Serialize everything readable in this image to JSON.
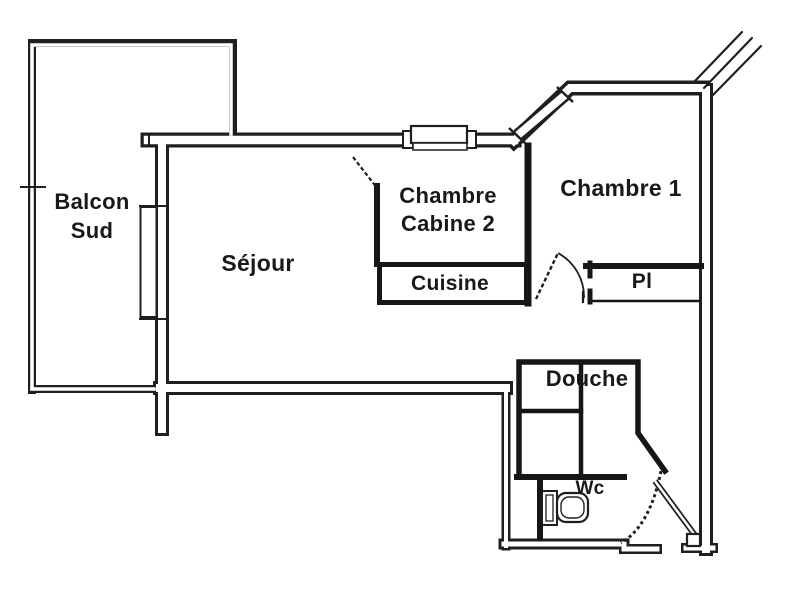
{
  "document": {
    "type": "apartment-floor-plan",
    "language": "fr"
  },
  "palette": {
    "wall": "#1f1f1f",
    "background": "#ffffff",
    "text": "#191919"
  },
  "rooms": {
    "balcon": {
      "label": "Balcon\nSud"
    },
    "sejour": {
      "label": "Séjour"
    },
    "cabine": {
      "label": "Chambre\nCabine 2"
    },
    "chambre1": {
      "label": "Chambre 1"
    },
    "cuisine": {
      "label": "Cuisine"
    },
    "placard": {
      "label": "Pl"
    },
    "douche": {
      "label": "Douche"
    },
    "wc": {
      "label": "Wc"
    }
  },
  "fixtures": {
    "toilet": "toilet-icon",
    "doors": [
      "cabine-door",
      "chambre1-door",
      "wc-door",
      "entry-door"
    ],
    "windows": [
      "balcony-french-window",
      "cabine-window",
      "chambre1-diagonal-window"
    ]
  }
}
